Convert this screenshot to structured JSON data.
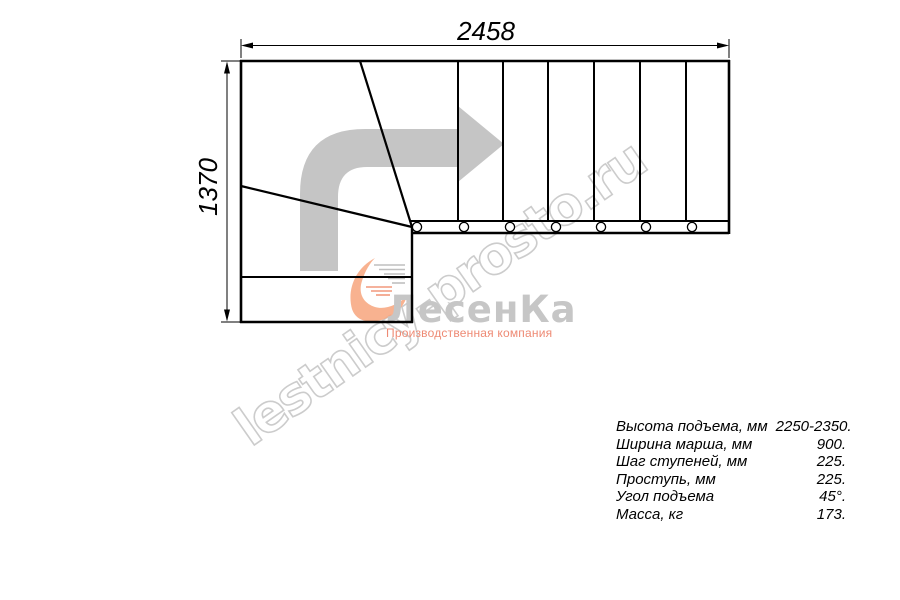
{
  "drawing": {
    "top_dimension": "2458",
    "left_dimension": "1370"
  },
  "watermark": {
    "text": "lestnicy-prosto.ru"
  },
  "logo": {
    "title": "ЛесенКа",
    "subtitle": "Производственная компания"
  },
  "specs": {
    "rows": [
      {
        "label": "Высота подъема, мм",
        "value": "2250-2350."
      },
      {
        "label": "Ширина марша, мм",
        "value": "900."
      },
      {
        "label": "Шаг ступеней, мм",
        "value": "225."
      },
      {
        "label": "Проступь, мм",
        "value": "225."
      },
      {
        "label": "Угол подъема",
        "value": "45°."
      },
      {
        "label": "Масса, кг",
        "value": "173."
      }
    ]
  },
  "icons": {
    "direction_arrow": "turn-right-arrow",
    "logo_swirl": "orange-swirl"
  },
  "colors": {
    "line": "#000000",
    "arrow_gray": "#c5c5c5",
    "watermark_gray": "#cccccc",
    "logo_text_gray": "#c6c6c6",
    "logo_accent": "#ee8a74",
    "swirl_orange": "#f7a57c"
  }
}
